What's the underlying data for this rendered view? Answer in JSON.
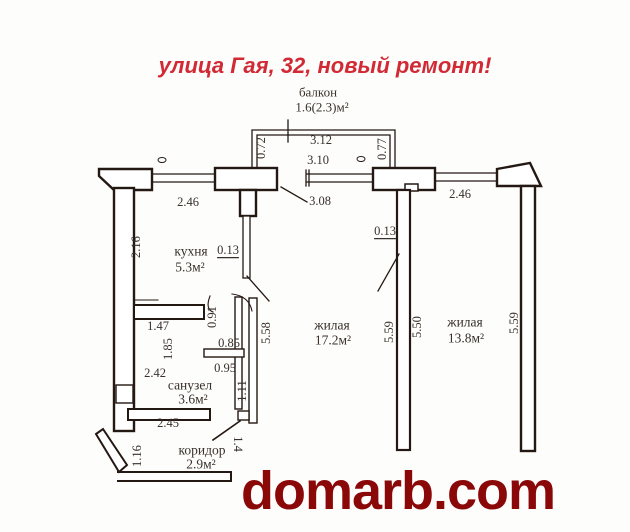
{
  "title": {
    "text": "улица Гая, 32, новый ремонт!",
    "color": "#d22a35"
  },
  "watermark": {
    "text": "domarb.com",
    "color": "#8b0808"
  },
  "plan": {
    "wall_color": "#241812",
    "text_color": "#39302a",
    "rooms_summary": [
      {
        "name": "балкон",
        "area": "1.6(2.3)м²"
      },
      {
        "name": "кухня",
        "area": "5.3м²"
      },
      {
        "name": "жилая",
        "area": "17.2м²"
      },
      {
        "name": "жилая",
        "area": "13.8м²"
      },
      {
        "name": "санузел",
        "area": "3.6м²"
      },
      {
        "name": "коридор",
        "area": "2.9м²"
      }
    ],
    "labels": [
      {
        "name": "room-balcony-name",
        "text": "балкон",
        "x": 318,
        "y": 92,
        "size": 13
      },
      {
        "name": "room-balcony-area",
        "text": "1.6(2.3)м²",
        "x": 322,
        "y": 107,
        "size": 13
      },
      {
        "name": "dim",
        "text": "3.12",
        "x": 321,
        "y": 140
      },
      {
        "name": "dim",
        "text": "3.10",
        "x": 318,
        "y": 160
      },
      {
        "name": "dim",
        "text": "0.72",
        "x": 261,
        "y": 148,
        "rot": -90
      },
      {
        "name": "dim",
        "text": "0.77",
        "x": 382,
        "y": 149,
        "rot": -90
      },
      {
        "name": "dim",
        "text": "2.46",
        "x": 188,
        "y": 202
      },
      {
        "name": "dim",
        "text": "3.08",
        "x": 320,
        "y": 201
      },
      {
        "name": "dim",
        "text": "2.46",
        "x": 460,
        "y": 194
      },
      {
        "name": "dim",
        "text": "2.16",
        "x": 136,
        "y": 247,
        "rot": -90
      },
      {
        "name": "room-kitchen-name",
        "text": "кухня",
        "x": 191,
        "y": 251,
        "size": 13.5
      },
      {
        "name": "room-kitchen-area",
        "text": "5.3м²",
        "x": 190,
        "y": 267,
        "size": 13.5
      },
      {
        "name": "dim",
        "text": "0.13",
        "x": 228,
        "y": 250,
        "underline": true
      },
      {
        "name": "dim",
        "text": "0.13",
        "x": 385,
        "y": 231,
        "underline": true
      },
      {
        "name": "dim",
        "text": "1.47",
        "x": 158,
        "y": 326
      },
      {
        "name": "dim",
        "text": "0.91",
        "x": 212,
        "y": 317,
        "rot": -90
      },
      {
        "name": "dim",
        "text": "1.85",
        "x": 168,
        "y": 349,
        "rot": -90
      },
      {
        "name": "dim",
        "text": "0.85",
        "x": 229,
        "y": 343
      },
      {
        "name": "dim",
        "text": "5.58",
        "x": 266,
        "y": 333,
        "rot": -90
      },
      {
        "name": "dim",
        "text": "2.42",
        "x": 155,
        "y": 373
      },
      {
        "name": "dim",
        "text": "0.95",
        "x": 225,
        "y": 368
      },
      {
        "name": "room-bathroom-name",
        "text": "санузел",
        "x": 190,
        "y": 385,
        "size": 13.5
      },
      {
        "name": "room-bathroom-area",
        "text": "3.6м²",
        "x": 193,
        "y": 399,
        "size": 13.5
      },
      {
        "name": "dim",
        "text": "1.11",
        "x": 242,
        "y": 391,
        "rot": -90
      },
      {
        "name": "dim",
        "text": "2.45",
        "x": 168,
        "y": 423
      },
      {
        "name": "room-living1-name",
        "text": "жилая",
        "x": 332,
        "y": 325,
        "size": 13.5
      },
      {
        "name": "room-living1-area",
        "text": "17.2м²",
        "x": 333,
        "y": 340,
        "size": 13.5
      },
      {
        "name": "dim",
        "text": "5.59",
        "x": 389,
        "y": 332,
        "rot": -90
      },
      {
        "name": "dim",
        "text": "5.50",
        "x": 417,
        "y": 327,
        "rot": -90
      },
      {
        "name": "room-living2-name",
        "text": "жилая",
        "x": 465,
        "y": 322,
        "size": 13.5
      },
      {
        "name": "room-living2-area",
        "text": "13.8м²",
        "x": 466,
        "y": 338,
        "size": 13.5
      },
      {
        "name": "dim",
        "text": "5.59",
        "x": 514,
        "y": 323,
        "rot": -90
      },
      {
        "name": "dim",
        "text": "1.16",
        "x": 137,
        "y": 456,
        "rot": -90
      },
      {
        "name": "room-corridor-name",
        "text": "коридор",
        "x": 202,
        "y": 450,
        "size": 13.5
      },
      {
        "name": "room-corridor-area",
        "text": "2.9м²",
        "x": 201,
        "y": 464,
        "size": 13.5
      },
      {
        "name": "dim",
        "text": "1.4",
        "x": 238,
        "y": 444,
        "rot": 90
      }
    ]
  }
}
